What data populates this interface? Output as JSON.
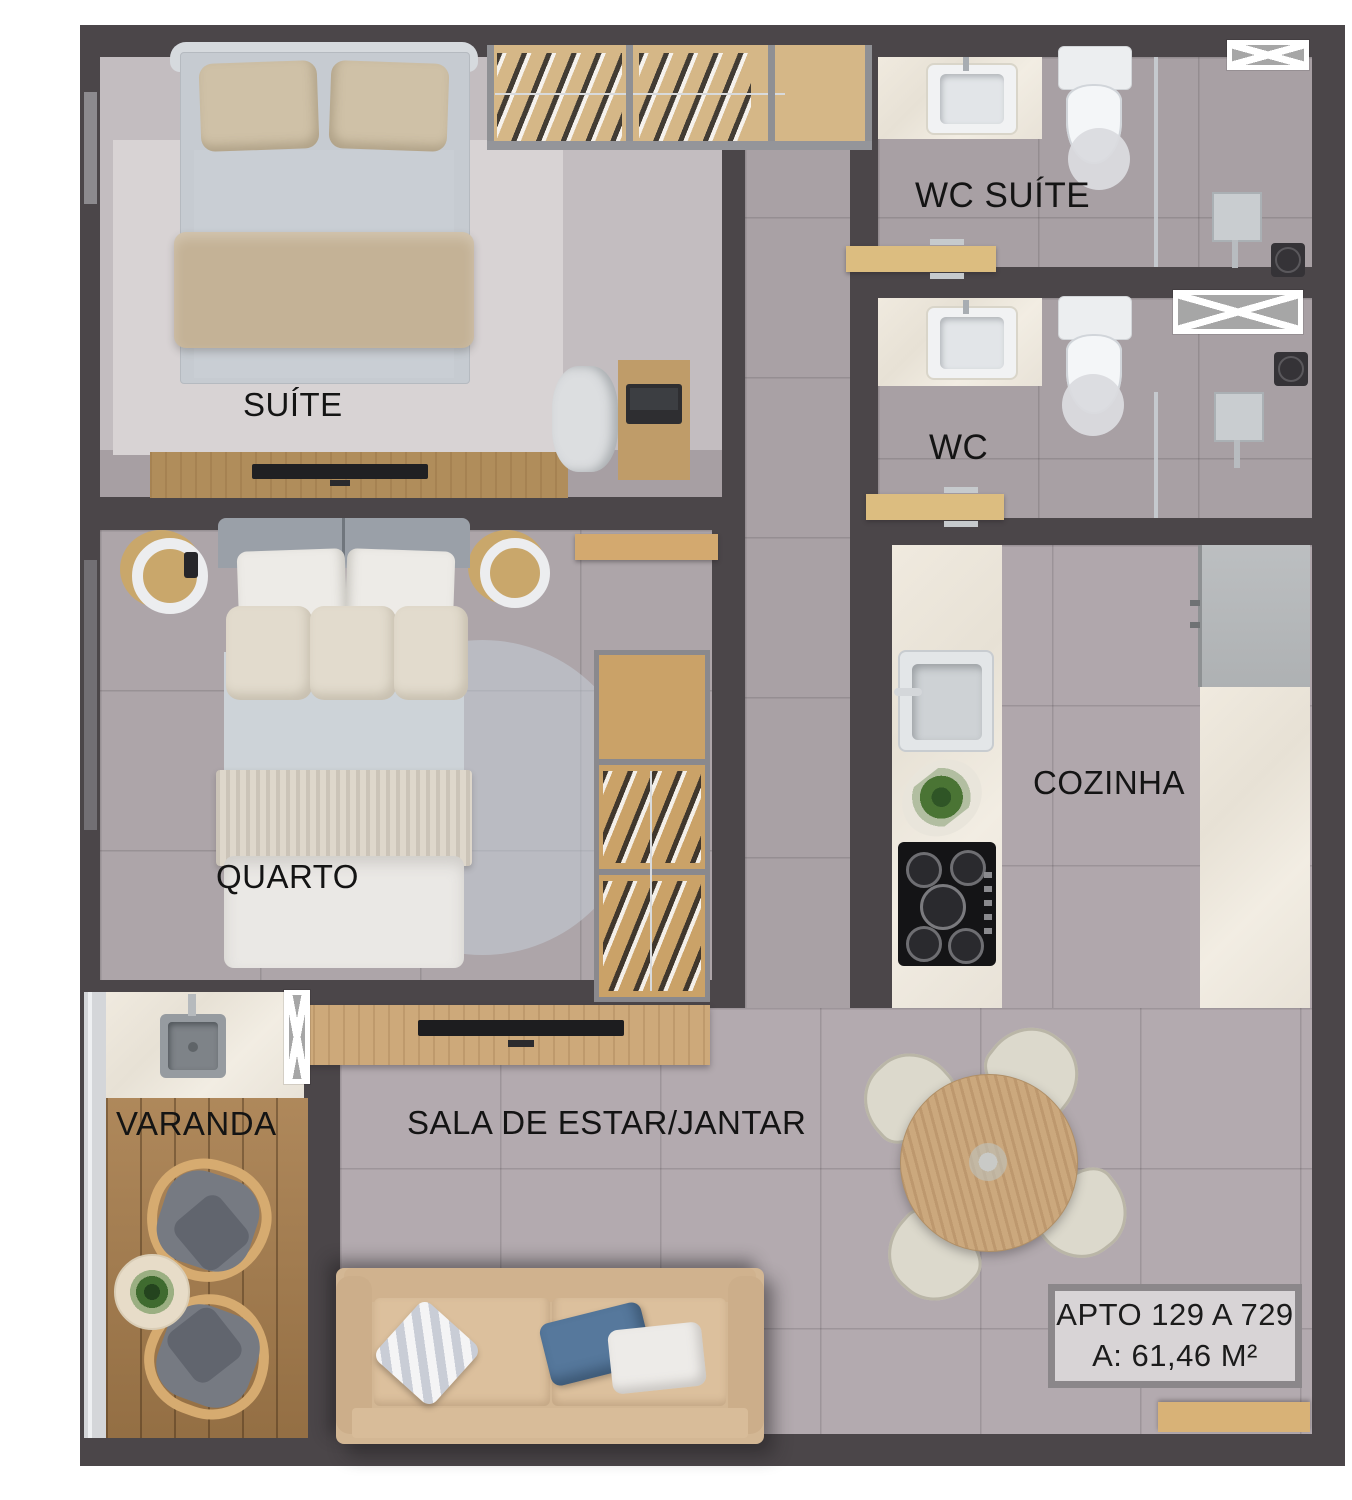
{
  "rooms": {
    "suite": {
      "label": "SUÍTE"
    },
    "wc_suite": {
      "label": "WC SUÍTE"
    },
    "wc": {
      "label": "WC"
    },
    "quarto": {
      "label": "QUARTO"
    },
    "cozinha": {
      "label": "COZINHA"
    },
    "sala": {
      "label": "SALA DE ESTAR/JANTAR"
    },
    "varanda": {
      "label": "VARANDA"
    }
  },
  "info_box": {
    "line1": "APTO 129 A 729",
    "line2": "A: 61,46 M²"
  },
  "icons": {
    "shaft_marker": "crossed-rectangle-window-marker"
  },
  "colors": {
    "wall": "#4b4649",
    "floor_gray": "#aea6aa",
    "wood": "#cda97a",
    "marble": "#ebe5da",
    "deck_wood": "#a87e4d",
    "sofa_beige": "#d5b995",
    "blue_pillow": "#56789c",
    "info_box_bg": "#d8d4d6",
    "info_box_border": "#8b878a"
  }
}
